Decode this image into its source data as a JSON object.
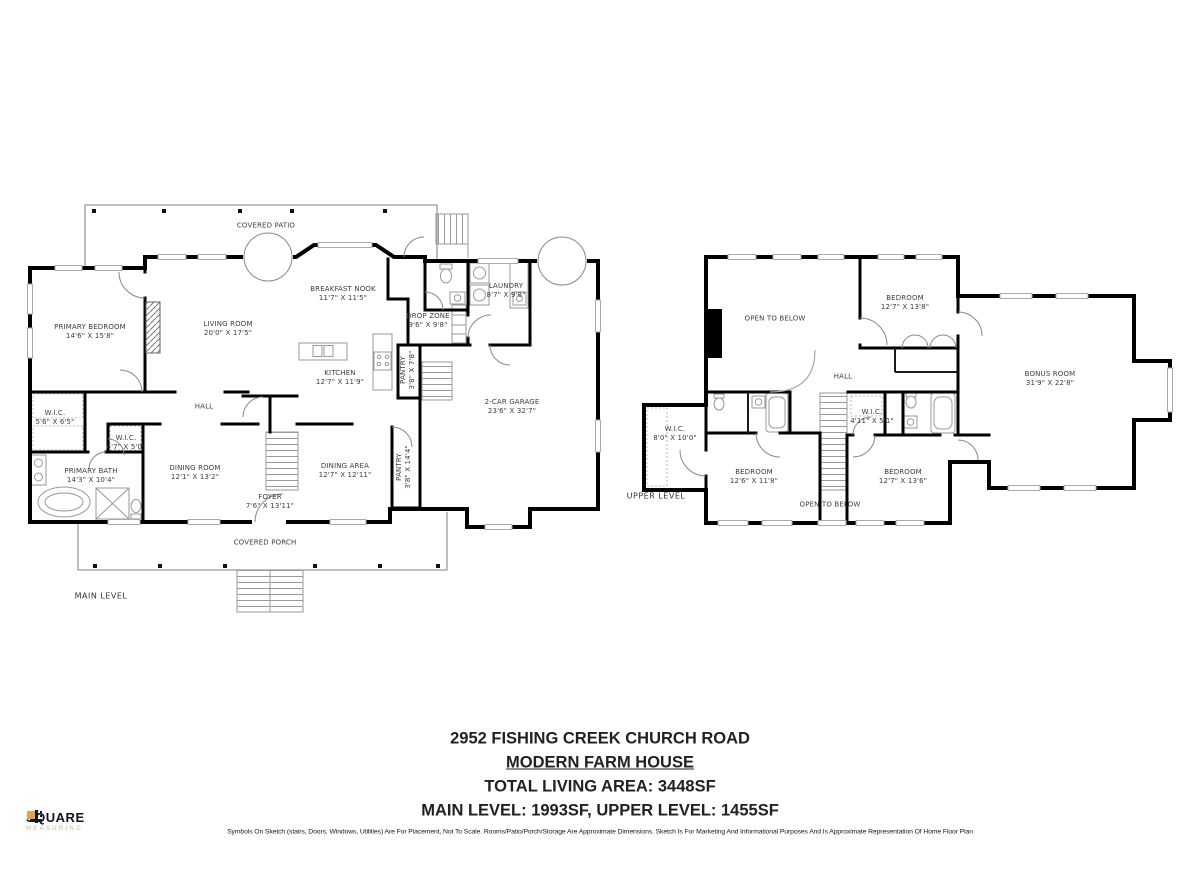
{
  "document": {
    "title_block": {
      "address": "2952 FISHING CREEK CHURCH ROAD",
      "style_name": "MODERN FARM HOUSE",
      "total_area": "TOTAL LIVING AREA: 3448SF",
      "level_areas": "MAIN LEVEL: 1993SF, UPPER LEVEL: 1455SF"
    },
    "disclaimer": "Symbols On Sketch (stairs, Doors, Windows, Utilities) Are For Placement, Not To Scale. Rooms/Patio/Porch/Storage Are Approximate Dimensions. Sketch Is For Marketing And Informational Purposes And Is Approximate Representation Of Home Floor Plan",
    "logo": {
      "name": "SQUARE",
      "tagline": "MEASURING"
    }
  },
  "main_level": {
    "level_label": "MAIN LEVEL",
    "areas": {
      "covered_patio": {
        "label": "COVERED PATIO"
      },
      "covered_porch": {
        "label": "COVERED PORCH"
      },
      "hall": {
        "label": "HALL"
      },
      "primary_bedroom": {
        "label": "PRIMARY BEDROOM",
        "dims": "14'6\" X 15'8\""
      },
      "living_room": {
        "label": "LIVING ROOM",
        "dims": "20'0\" X 17'5\""
      },
      "breakfast_nook": {
        "label": "BREAKFAST NOOK",
        "dims": "11'7\" X 11'5\""
      },
      "drop_zone": {
        "label": "DROP ZONE",
        "dims": "9'6\" X 9'8\""
      },
      "laundry": {
        "label": "LAUNDRY",
        "dims": "8'7\" X 9'8\""
      },
      "kitchen": {
        "label": "KITCHEN",
        "dims": "12'7\" X 11'9\""
      },
      "pantry_small": {
        "label": "PANTRY",
        "dims": "3'8\" X 7'8\""
      },
      "garage": {
        "label": "2-CAR GARAGE",
        "dims": "23'6\" X 32'7\""
      },
      "wic_bedroom": {
        "label": "W.I.C.",
        "dims": "5'6\" X 6'5\""
      },
      "wic_hall": {
        "label": "W.I.C.",
        "dims": "4'7\" X 5'0\""
      },
      "primary_bath": {
        "label": "PRIMARY BATH",
        "dims": "14'3\" X 10'4\""
      },
      "dining_room": {
        "label": "DINING ROOM",
        "dims": "12'1\" X 13'2\""
      },
      "dining_area": {
        "label": "DINING AREA",
        "dims": "12'7\" X 12'11\""
      },
      "pantry_tall": {
        "label": "PANTRY",
        "dims": "3'8\" X 14'4\""
      },
      "foyer": {
        "label": "FOYER",
        "dims": "7'6\" X 13'11\""
      }
    }
  },
  "upper_level": {
    "level_label": "UPPER LEVEL",
    "areas": {
      "open_to_below_top": {
        "label": "OPEN TO BELOW"
      },
      "open_to_below_bottom": {
        "label": "OPEN TO BELOW"
      },
      "hall": {
        "label": "HALL"
      },
      "bedroom_top": {
        "label": "BEDROOM",
        "dims": "12'7\" X 13'8\""
      },
      "wic_left": {
        "label": "W.I.C.",
        "dims": "8'0\" X 10'0\""
      },
      "wic_center": {
        "label": "W.I.C.",
        "dims": "4'11\" X 5'1\""
      },
      "bonus_room": {
        "label": "BONUS ROOM",
        "dims": "31'9\" X 22'8\""
      },
      "bedroom_left": {
        "label": "BEDROOM",
        "dims": "12'6\" X 11'8\""
      },
      "bedroom_right": {
        "label": "BEDROOM",
        "dims": "12'7\" X 13'6\""
      }
    }
  }
}
